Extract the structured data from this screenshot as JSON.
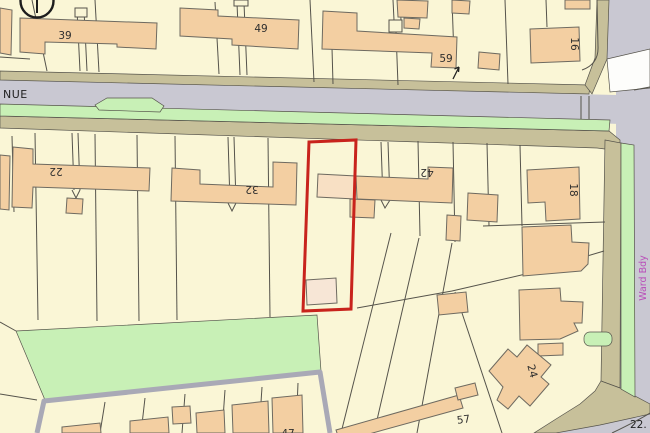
{
  "map": {
    "type": "ordnance-survey-style site location plan",
    "colors": {
      "parcel": "#FAF6D6",
      "building": "#F3CFA2",
      "building_light": "#F8E0C4",
      "outbuilding_light": "#F7E6D6",
      "road": "#C9C8D2",
      "white_road": "#FDFDFB",
      "verge_green": "#C8F0B6",
      "path_khaki": "#C7C09A",
      "track_grey": "#A9A9B6",
      "line": "#55534B",
      "building_line": "#6E6A60",
      "plot_red": "#C8231C",
      "boundary_magenta": "#B94FB9",
      "text": "#2E2E2E"
    },
    "labels": [
      {
        "text": "39",
        "x": 65,
        "y": 39,
        "rot": 0,
        "kind": "house"
      },
      {
        "text": "49",
        "x": 261,
        "y": 32,
        "rot": 0,
        "kind": "house"
      },
      {
        "text": "59",
        "x": 446,
        "y": 62,
        "rot": 0,
        "kind": "house"
      },
      {
        "text": "16",
        "x": 571,
        "y": 44,
        "rot": 90,
        "kind": "house"
      },
      {
        "text": "22",
        "x": 56,
        "y": 168,
        "rot": 180,
        "kind": "house"
      },
      {
        "text": "32",
        "x": 252,
        "y": 186,
        "rot": 180,
        "kind": "house"
      },
      {
        "text": "42",
        "x": 427,
        "y": 169,
        "rot": 180,
        "kind": "house"
      },
      {
        "text": "18",
        "x": 570,
        "y": 190,
        "rot": 90,
        "kind": "house"
      },
      {
        "text": "24",
        "x": 529,
        "y": 372,
        "rot": 75,
        "kind": "house"
      },
      {
        "text": "57",
        "x": 464,
        "y": 423,
        "rot": -8,
        "kind": "house"
      },
      {
        "text": "47",
        "x": 288,
        "y": 437,
        "rot": 0,
        "kind": "house"
      },
      {
        "text": "NUE",
        "x": 3,
        "y": 98,
        "rot": 0,
        "kind": "street",
        "anchor": "start"
      },
      {
        "text": "Ward Bdy",
        "x": 646,
        "y": 278,
        "rot": -90,
        "kind": "boundary"
      },
      {
        "text": "22.",
        "x": 630,
        "y": 428,
        "rot": 0,
        "kind": "spot",
        "anchor": "start"
      }
    ]
  }
}
